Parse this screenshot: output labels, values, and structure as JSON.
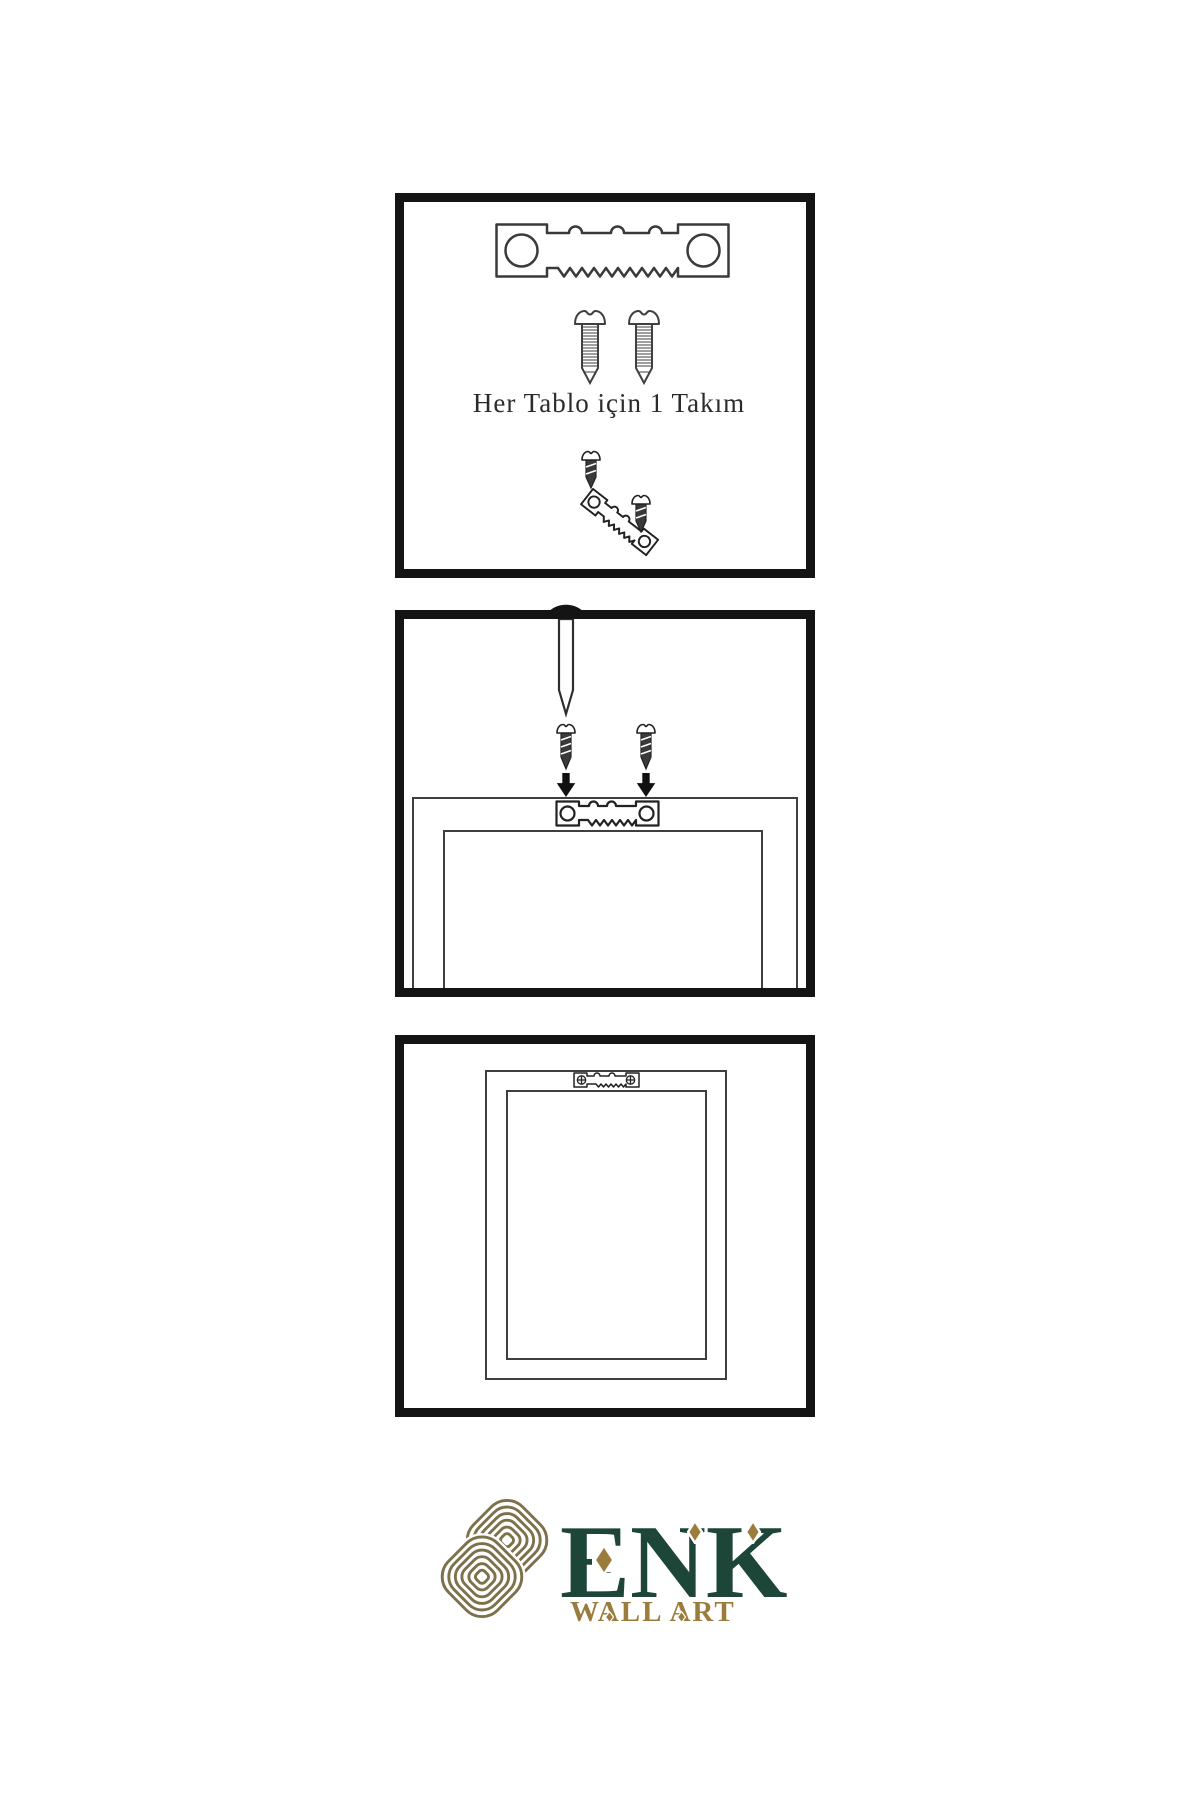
{
  "canvas": {
    "bg": "#ffffff",
    "border": "#141414",
    "ink": "#2b2b2b",
    "lineart": "#3f3f3f"
  },
  "step_kit": {
    "caption": "Her Tablo için 1 Takım"
  },
  "brand": {
    "name": "ENK",
    "tagline": "WALL ART",
    "green": "#1e4638",
    "gold": "#9c7c3c",
    "knot_gold": "#7c714b"
  },
  "icons": {
    "sawtooth_hanger": "sawtooth-hanger-icon",
    "screw": "screw-icon",
    "nail": "nail-icon",
    "arrow_down": "arrow-down-icon",
    "knot_logo": "knot-logo",
    "diamond": "diamond-ornament"
  }
}
